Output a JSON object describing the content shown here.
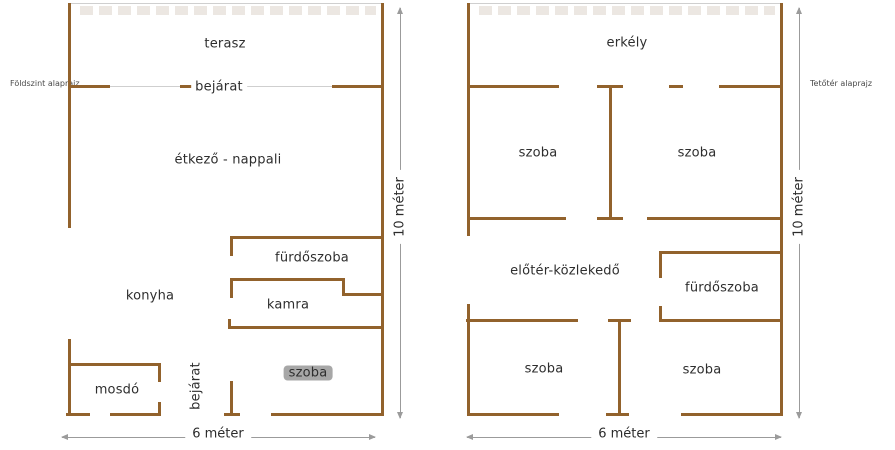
{
  "colors": {
    "wall": "#92622c",
    "thin_line": "#cfcfcf",
    "hatch": "#d8cfc6",
    "dim_line": "#9b9b9b",
    "text": "#2e2e2e"
  },
  "plans": [
    {
      "name": "foldszint",
      "title": {
        "text": "Földszint alaprajz",
        "x": 10,
        "y": 79
      },
      "hatch": {
        "x": 80,
        "y": 6,
        "w": 296,
        "h": 9
      },
      "thin_lines": [
        {
          "x": 68,
          "y": 3,
          "w": 316,
          "h": 1
        },
        {
          "x": 108,
          "y": 86,
          "w": 226,
          "h": 1
        }
      ],
      "walls": [
        {
          "x": 68,
          "y": 85,
          "w": 42,
          "h": 3
        },
        {
          "x": 180,
          "y": 85,
          "w": 12,
          "h": 3
        },
        {
          "x": 232,
          "y": 85,
          "w": 10,
          "h": 3
        },
        {
          "x": 332,
          "y": 85,
          "w": 50,
          "h": 3
        },
        {
          "x": 230,
          "y": 236,
          "w": 151,
          "h": 3
        },
        {
          "x": 230,
          "y": 278,
          "w": 114,
          "h": 3
        },
        {
          "x": 342,
          "y": 293,
          "w": 41,
          "h": 3
        },
        {
          "x": 228,
          "y": 326,
          "w": 156,
          "h": 3
        },
        {
          "x": 68,
          "y": 363,
          "w": 92,
          "h": 3
        },
        {
          "x": 66,
          "y": 413,
          "w": 24,
          "h": 3
        },
        {
          "x": 110,
          "y": 413,
          "w": 50,
          "h": 3
        },
        {
          "x": 224,
          "y": 413,
          "w": 16,
          "h": 3
        },
        {
          "x": 271,
          "y": 413,
          "w": 113,
          "h": 3
        },
        {
          "x": 68,
          "y": 3,
          "w": 3,
          "h": 225
        },
        {
          "x": 68,
          "y": 339,
          "w": 3,
          "h": 77
        },
        {
          "x": 381,
          "y": 3,
          "w": 3,
          "h": 413
        },
        {
          "x": 230,
          "y": 236,
          "w": 3,
          "h": 20
        },
        {
          "x": 230,
          "y": 278,
          "w": 3,
          "h": 20
        },
        {
          "x": 342,
          "y": 278,
          "w": 3,
          "h": 18
        },
        {
          "x": 228,
          "y": 319,
          "w": 3,
          "h": 10
        },
        {
          "x": 158,
          "y": 363,
          "w": 3,
          "h": 19
        },
        {
          "x": 158,
          "y": 402,
          "w": 3,
          "h": 14
        },
        {
          "x": 230,
          "y": 381,
          "w": 3,
          "h": 35
        }
      ],
      "rooms": [
        {
          "name": "terasz",
          "label": "terasz",
          "x": 225,
          "y": 44
        },
        {
          "name": "bejarat-top",
          "label": "bejárat",
          "x": 219,
          "y": 87,
          "onwall": true
        },
        {
          "name": "etkezo-nappali",
          "label": "étkező - nappali",
          "x": 228,
          "y": 160
        },
        {
          "name": "furdoszoba",
          "label": "fürdőszoba",
          "x": 312,
          "y": 258
        },
        {
          "name": "konyha",
          "label": "konyha",
          "x": 150,
          "y": 296
        },
        {
          "name": "kamra",
          "label": "kamra",
          "x": 288,
          "y": 305
        },
        {
          "name": "mosdo",
          "label": "mosdó",
          "x": 117,
          "y": 390
        },
        {
          "name": "bejarat-bottom",
          "label": "bejárat",
          "x": 196,
          "y": 386,
          "rotate": true
        },
        {
          "name": "szoba-highlighted",
          "label": "szoba",
          "x": 308,
          "y": 373,
          "highlight": true
        }
      ],
      "dims": [
        {
          "type": "v",
          "x": 400,
          "y1": 8,
          "y2": 418,
          "label": "10 méter",
          "lx": 400,
          "ly": 207
        },
        {
          "type": "h",
          "y": 437,
          "x1": 62,
          "x2": 375,
          "label": "6 méter",
          "lx": 218,
          "ly": 434
        }
      ]
    },
    {
      "name": "tetoter",
      "title": {
        "text": "Tetőtér alaprajz",
        "x": 810,
        "y": 79
      },
      "hatch": {
        "x": 479,
        "y": 6,
        "w": 296,
        "h": 9
      },
      "thin_lines": [
        {
          "x": 467,
          "y": 3,
          "w": 315,
          "h": 1
        }
      ],
      "walls": [
        {
          "x": 467,
          "y": 85,
          "w": 92,
          "h": 3
        },
        {
          "x": 597,
          "y": 85,
          "w": 26,
          "h": 3
        },
        {
          "x": 669,
          "y": 85,
          "w": 14,
          "h": 3
        },
        {
          "x": 719,
          "y": 85,
          "w": 63,
          "h": 3
        },
        {
          "x": 467,
          "y": 217,
          "w": 99,
          "h": 3
        },
        {
          "x": 597,
          "y": 217,
          "w": 26,
          "h": 3
        },
        {
          "x": 647,
          "y": 217,
          "w": 135,
          "h": 3
        },
        {
          "x": 659,
          "y": 251,
          "w": 122,
          "h": 3
        },
        {
          "x": 466,
          "y": 319,
          "w": 112,
          "h": 3
        },
        {
          "x": 608,
          "y": 319,
          "w": 23,
          "h": 3
        },
        {
          "x": 659,
          "y": 319,
          "w": 122,
          "h": 3
        },
        {
          "x": 467,
          "y": 413,
          "w": 92,
          "h": 3
        },
        {
          "x": 606,
          "y": 413,
          "w": 23,
          "h": 3
        },
        {
          "x": 681,
          "y": 413,
          "w": 101,
          "h": 3
        },
        {
          "x": 467,
          "y": 3,
          "w": 3,
          "h": 233
        },
        {
          "x": 467,
          "y": 304,
          "w": 3,
          "h": 112
        },
        {
          "x": 780,
          "y": 3,
          "w": 3,
          "h": 413
        },
        {
          "x": 609,
          "y": 85,
          "w": 3,
          "h": 134
        },
        {
          "x": 659,
          "y": 251,
          "w": 3,
          "h": 27
        },
        {
          "x": 659,
          "y": 306,
          "w": 3,
          "h": 16
        },
        {
          "x": 618,
          "y": 319,
          "w": 3,
          "h": 97
        }
      ],
      "rooms": [
        {
          "name": "erkely",
          "label": "erkély",
          "x": 627,
          "y": 43
        },
        {
          "name": "szoba-top-left",
          "label": "szoba",
          "x": 538,
          "y": 153
        },
        {
          "name": "szoba-top-right",
          "label": "szoba",
          "x": 697,
          "y": 153
        },
        {
          "name": "eloter-kozlekedo",
          "label": "előtér-közlekedő",
          "x": 565,
          "y": 271
        },
        {
          "name": "furdoszoba",
          "label": "fürdőszoba",
          "x": 722,
          "y": 288
        },
        {
          "name": "szoba-bottom-left",
          "label": "szoba",
          "x": 544,
          "y": 369
        },
        {
          "name": "szoba-bottom-right",
          "label": "szoba",
          "x": 702,
          "y": 370
        }
      ],
      "dims": [
        {
          "type": "v",
          "x": 799,
          "y1": 8,
          "y2": 418,
          "label": "10 méter",
          "lx": 799,
          "ly": 207
        },
        {
          "type": "h",
          "y": 437,
          "x1": 467,
          "x2": 781,
          "label": "6 méter",
          "lx": 624,
          "ly": 434
        }
      ]
    }
  ]
}
